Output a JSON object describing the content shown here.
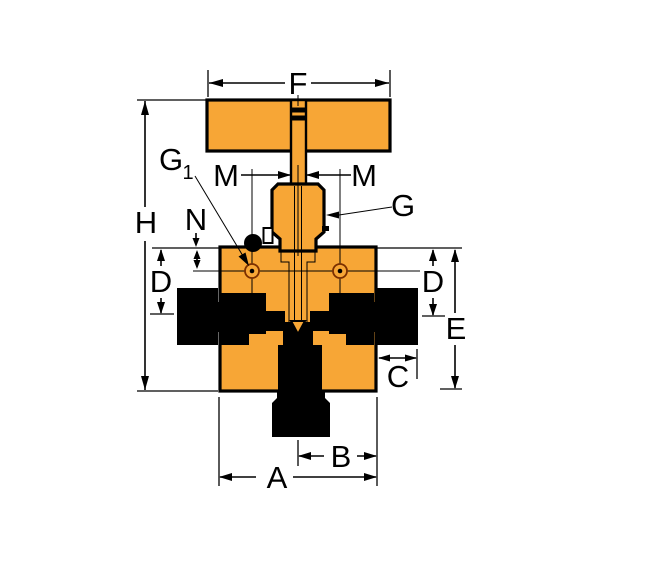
{
  "diagram": {
    "type": "valve-dimensional-drawing",
    "labels": {
      "A": "A",
      "B": "B",
      "C": "C",
      "D": "D",
      "E": "E",
      "F": "F",
      "G": "G",
      "G1_main": "G",
      "G1_sub": "1",
      "H": "H",
      "M": "M",
      "N": "N"
    },
    "colors": {
      "body_fill": "#F7A636",
      "outline": "#000000",
      "port_ring": "#7B2F00",
      "background": "#FFFFFF"
    }
  }
}
